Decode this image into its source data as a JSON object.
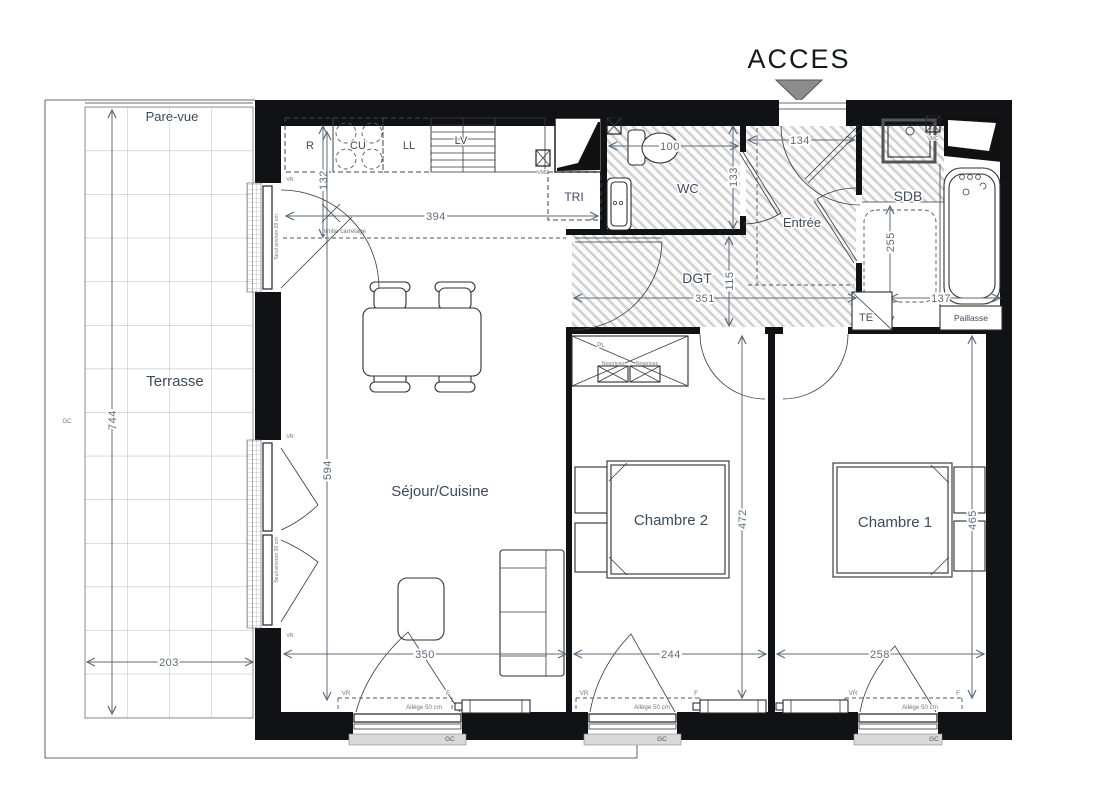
{
  "colors": {
    "wall": "#101215",
    "label": "#3d4a5c",
    "dim": "#5f6b7a",
    "hatch": "#cfcfcf",
    "arrow_fill": "#8c8c8c",
    "sill": "#d9d9d9"
  },
  "access": {
    "label": "ACCES"
  },
  "terrace": {
    "label": "Terrasse",
    "pare_vue": "Pare-vue",
    "gc": "GC",
    "dim_height": "744",
    "dim_width": "203"
  },
  "kitchen": {
    "fridge": "R",
    "hob": "CU",
    "washer": "LL",
    "dishwasher": "LV",
    "tri": "TRI",
    "vmc": "VMC",
    "dim_width": "394",
    "dim_depth": "132",
    "tile_limit": "limite carrelage"
  },
  "wc": {
    "label": "WC",
    "dim_width": "100",
    "dim_depth": "133"
  },
  "entree": {
    "label": "Entrée",
    "dim_width": "134"
  },
  "sdb": {
    "label": "SDB",
    "dim_depth": "255",
    "dim_width": "137",
    "paillasse": "Paillasse",
    "te": "TE"
  },
  "dgt": {
    "label": "DGT",
    "dim_width": "351",
    "dim_depth": "115",
    "pl": "PL",
    "nourrices": "Nourrices"
  },
  "sejour": {
    "label": "Séjour/Cuisine",
    "dim_height": "594",
    "dim_width": "350"
  },
  "chambre2": {
    "label": "Chambre 2",
    "dim_height": "472",
    "dim_width": "244"
  },
  "chambre1": {
    "label": "Chambre 1",
    "dim_height": "465",
    "dim_width": "258"
  },
  "openings": {
    "vr": "VR",
    "f": "F",
    "gc": "GC",
    "allege": "Allège 50 cm",
    "seuil": "Seuil environ 20 cm"
  }
}
